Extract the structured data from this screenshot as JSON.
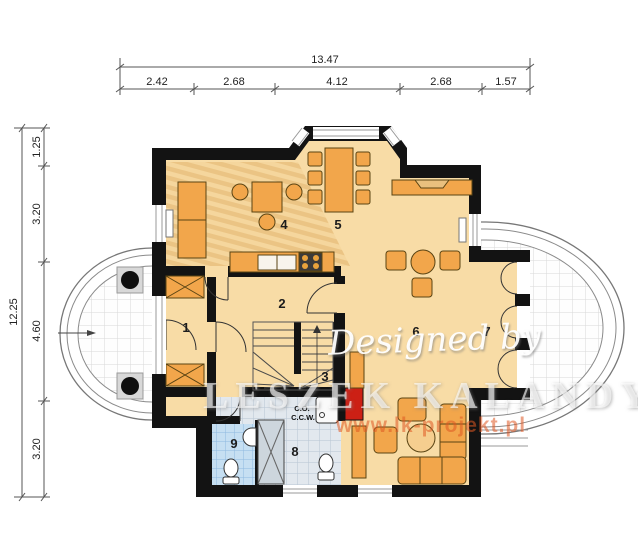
{
  "dims_top": {
    "total": "13.47",
    "segments": [
      "2.42",
      "2.68",
      "4.12",
      "2.68",
      "1.57"
    ]
  },
  "dims_left": {
    "total": "12.25",
    "segments": [
      "1.25",
      "3.20",
      "4.60",
      "3.20"
    ]
  },
  "rooms": [
    "1",
    "2",
    "3",
    "4",
    "5",
    "6",
    "7",
    "8",
    "9"
  ],
  "boiler": {
    "line1": "C.O.",
    "line2": "C.C.W."
  },
  "watermark": {
    "script": "Designed by",
    "name": "LESZEK KALANDYK",
    "url": "www.lk-projekt.pl"
  },
  "colors": {
    "wall": "#131313",
    "floor": "#F8DCA6",
    "furniture": "#F2A64B",
    "chimney_red": "#CC2015",
    "tile_blue": "#C6DFF2",
    "tile_gray": "#E2E8EE",
    "terrace_grid": "#D8D8D8",
    "watermark_orange": "#DE5822"
  }
}
